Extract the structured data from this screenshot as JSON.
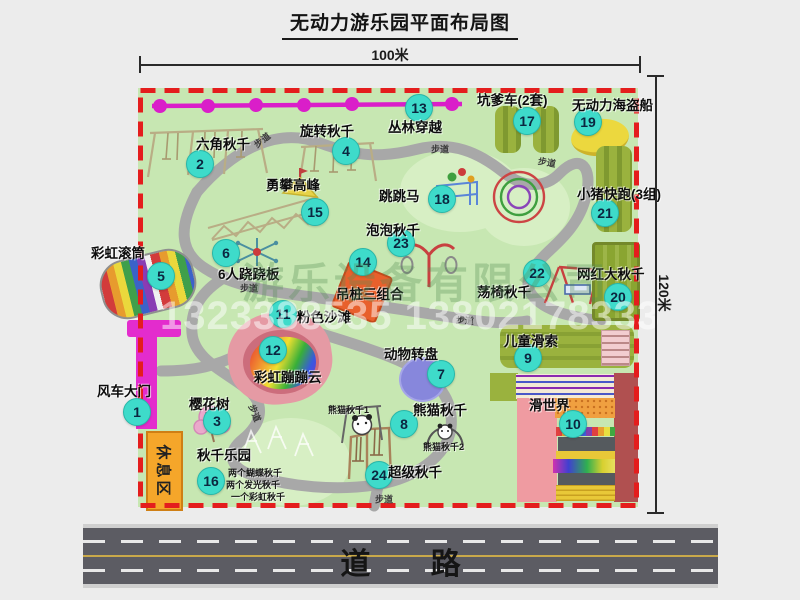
{
  "title": "无动力游乐园平面布局图",
  "dimensions": {
    "top": "100米",
    "right": "120米"
  },
  "road": {
    "label": "道 路"
  },
  "watermark": {
    "company": "游乐设备有限公司",
    "phone": "1323388535 13802178333"
  },
  "rest_area": {
    "label": "休息区"
  },
  "walkway_label": "步道",
  "map": {
    "attractions": [
      {
        "num": 1,
        "name": "风车大门",
        "badge": [
          136,
          411
        ],
        "label": [
          97,
          380
        ]
      },
      {
        "num": 2,
        "name": "六角秋千",
        "badge": [
          199,
          163
        ],
        "label": [
          196,
          133
        ]
      },
      {
        "num": 3,
        "name": "樱花树",
        "badge": [
          216,
          420
        ],
        "label": [
          189,
          393
        ]
      },
      {
        "num": 4,
        "name": "旋转秋千",
        "badge": [
          345,
          150
        ],
        "label": [
          300,
          120
        ]
      },
      {
        "num": 5,
        "name": "彩虹滚筒",
        "badge": [
          160,
          275
        ],
        "label": [
          91,
          242
        ]
      },
      {
        "num": 6,
        "name": "6人跷跷板",
        "badge": [
          225,
          252
        ],
        "label": [
          218,
          263
        ]
      },
      {
        "num": 7,
        "name": "动物转盘",
        "badge": [
          440,
          373
        ],
        "label": [
          384,
          343
        ]
      },
      {
        "num": 8,
        "name": "熊猫秋千",
        "badge": [
          403,
          423
        ],
        "label": [
          413,
          399
        ]
      },
      {
        "num": 9,
        "name": "儿童滑索",
        "badge": [
          527,
          357
        ],
        "label": [
          504,
          330
        ]
      },
      {
        "num": 10,
        "name": "滑世界",
        "badge": [
          572,
          423
        ],
        "label": [
          529,
          394
        ]
      },
      {
        "num": 11,
        "name": "粉色沙滩",
        "badge": [
          282,
          313
        ],
        "label": [
          297,
          306
        ]
      },
      {
        "num": 12,
        "name": "彩虹蹦蹦云",
        "badge": [
          272,
          349
        ],
        "label": [
          254,
          366
        ]
      },
      {
        "num": 13,
        "name": "丛林穿越",
        "badge": [
          418,
          107
        ],
        "label": [
          388,
          116
        ]
      },
      {
        "num": 14,
        "name": "吊桩三组合",
        "badge": [
          362,
          261
        ],
        "label": [
          336,
          283
        ]
      },
      {
        "num": 15,
        "name": "勇攀高峰",
        "badge": [
          314,
          211
        ],
        "label": [
          266,
          174
        ]
      },
      {
        "num": 16,
        "name": "秋千乐园",
        "badge": [
          210,
          480
        ],
        "label": [
          197,
          444
        ]
      },
      {
        "num": 17,
        "name": "坑爹车(2套)",
        "badge": [
          526,
          120
        ],
        "label": [
          477,
          89
        ]
      },
      {
        "num": 18,
        "name": "跳跳马",
        "badge": [
          441,
          198
        ],
        "label": [
          379,
          185
        ]
      },
      {
        "num": 19,
        "name": "无动力海盗船",
        "badge": [
          587,
          121
        ],
        "label": [
          572,
          94
        ]
      },
      {
        "num": 20,
        "name": "网红大秋千",
        "badge": [
          617,
          296
        ],
        "label": [
          577,
          263
        ]
      },
      {
        "num": 21,
        "name": "小猪快跑(3组)",
        "badge": [
          604,
          212
        ],
        "label": [
          577,
          183
        ]
      },
      {
        "num": 22,
        "name": "荡椅秋千",
        "badge": [
          536,
          272
        ],
        "label": [
          477,
          281
        ]
      },
      {
        "num": 23,
        "name": "泡泡秋千",
        "badge": [
          400,
          242
        ],
        "label": [
          366,
          219
        ]
      },
      {
        "num": 24,
        "name": "超级秋千",
        "badge": [
          378,
          474
        ],
        "label": [
          388,
          461
        ]
      }
    ],
    "notes": [
      {
        "text": "熊猫秋千1",
        "pos": [
          328,
          403
        ]
      },
      {
        "text": "熊猫秋千2",
        "pos": [
          423,
          440
        ]
      },
      {
        "text": "两个蝴蝶秋千",
        "pos": [
          228,
          466
        ]
      },
      {
        "text": "两个发光秋千",
        "pos": [
          226,
          478
        ]
      },
      {
        "text": "一个彩虹秋千",
        "pos": [
          231,
          490
        ]
      }
    ],
    "walkways": [
      {
        "pos": [
          262,
          140
        ],
        "rot": -38
      },
      {
        "pos": [
          440,
          149
        ],
        "rot": 0
      },
      {
        "pos": [
          547,
          162
        ],
        "rot": 10
      },
      {
        "pos": [
          249,
          288
        ],
        "rot": 0
      },
      {
        "pos": [
          465,
          320
        ],
        "rot": 5
      },
      {
        "pos": [
          255,
          413
        ],
        "rot": 68
      },
      {
        "pos": [
          384,
          499
        ],
        "rot": 0
      }
    ]
  },
  "colors": {
    "park_fill": "#c7e7b2",
    "border_red": "#e41d1d",
    "path_gray": "#a8a8a8",
    "badge_cyan": "#3edbca",
    "gate_magenta": "#e32ccd",
    "olive_green": "#9ab23e",
    "road_gray": "#5c5c63",
    "rest_orange": "#f5a62a"
  }
}
